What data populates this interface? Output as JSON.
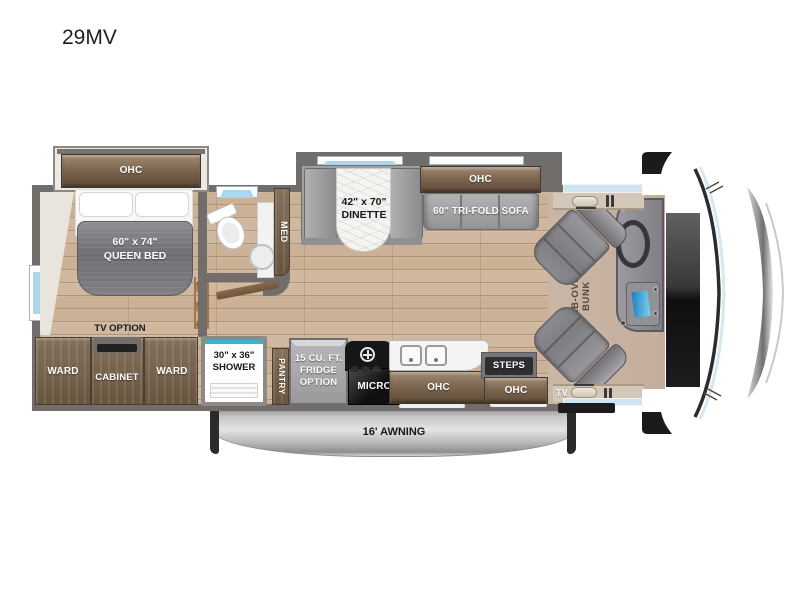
{
  "title": "29MV",
  "colors": {
    "wall": "#716d6a",
    "wood": "#cfb89f",
    "cabinet_brown": "#7d6750",
    "accent_teal": "#35b8c6",
    "window_blue": "#aed6ea",
    "screen_blue": "#2f9fd8",
    "awning_silver": "#c6c6c8"
  },
  "bedroom": {
    "ohc_label": "OHC",
    "bed_line1": "60\" x 74\"",
    "bed_line2": "QUEEN BED",
    "tv_option_label": "TV OPTION",
    "ward_left_label": "WARD",
    "cabinet_label": "CABINET",
    "ward_right_label": "WARD"
  },
  "bath": {
    "med_label": "MED",
    "shower_line1": "30\" x 36\"",
    "shower_line2": "SHOWER"
  },
  "kitchen": {
    "pantry_label": "PANTRY",
    "fridge_line1": "15 CU. FT.",
    "fridge_line2": "FRIDGE",
    "fridge_line3": "OPTION",
    "micro_label": "MICRO",
    "ohc_label": "OHC",
    "steps_label": "STEPS",
    "entry_ohc_label": "OHC",
    "entry_tv_label": "TV"
  },
  "living": {
    "dinette_line1": "42\" x 70\"",
    "dinette_line2": "DINETTE",
    "sofa_ohc_label": "OHC",
    "sofa_label": "60\" TRI-FOLD SOFA",
    "bunk_line1": "CAB-OVER",
    "bunk_line2": "BUNK"
  },
  "exterior": {
    "awning_label": "16' AWNING"
  }
}
